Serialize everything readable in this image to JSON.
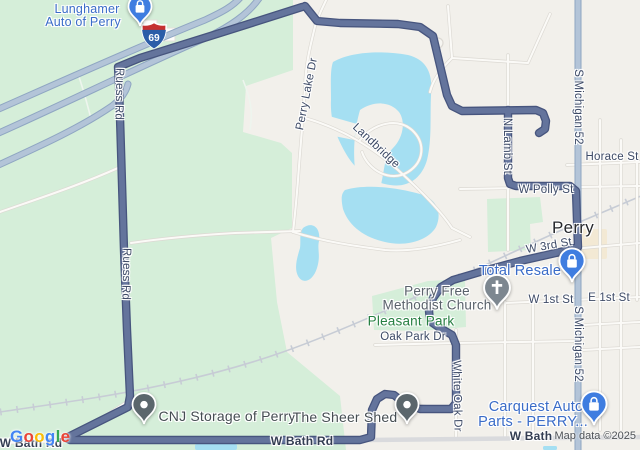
{
  "colors": {
    "background": "#f2f0eb",
    "vegetation": "#d5eed9",
    "water": "#a5dff2",
    "route": "#64749c",
    "route_casing": "#47557e",
    "major_road": "#b3c4d8",
    "poi_blue": "#3a6cc8",
    "park_label": "#278042",
    "street_label": "#3d4a66",
    "city_label": "#26282c",
    "pin_blue": "#3f7de0",
    "pin_gray": "#5b666c",
    "pin_church": "#7d8790",
    "shield_blue": "#2b5da8",
    "shield_red": "#c53030"
  },
  "shield": {
    "route_number": "69"
  },
  "city_label": "Perry",
  "poi_labels": {
    "lunghamer_line1": "Lunghamer",
    "lunghamer_line2": "Auto of Perry",
    "total_resale": "Total Resale",
    "church_line1": "Perry Free",
    "church_line2": "Methodist Church",
    "pleasant_park": "Pleasant Park",
    "cnj_storage": "CNJ Storage of Perry",
    "sheer_shed": "The Sheer Shed",
    "carquest_line1": "Carquest Auto",
    "carquest_line2": "Parts - PERRY..."
  },
  "road_labels": {
    "ruess_1": "Ruess Rd",
    "ruess_2": "Ruess Rd",
    "perry_lake": "Perry Lake Dr",
    "landbridge": "Landbridge",
    "n_lamb": "N Lamb St",
    "s_michigan_1": "S Michigan 52",
    "s_michigan_2": "S Michigan 52",
    "horace": "Horace St",
    "w_polly": "W Polly St",
    "w_3rd": "W 3rd St",
    "w_1st": "W 1st St",
    "e_1st": "E 1st St",
    "oak_park": "Oak Park Dr",
    "white_oak": "White Oak Dr",
    "w_bath_center": "W Bath Rd",
    "w_bath_left": "W Bath Rd",
    "w_bath_right": "W Bath"
  },
  "attribution": {
    "map_data": "Map data ©2025"
  },
  "logo_letters": [
    {
      "ch": "G",
      "style": "color:#4285F4"
    },
    {
      "ch": "o",
      "style": "color:#EA4335"
    },
    {
      "ch": "o",
      "style": "color:#FBBC05"
    },
    {
      "ch": "g",
      "style": "color:#4285F4"
    },
    {
      "ch": "l",
      "style": "color:#34A853"
    },
    {
      "ch": "e",
      "style": "color:#EA4335"
    }
  ]
}
